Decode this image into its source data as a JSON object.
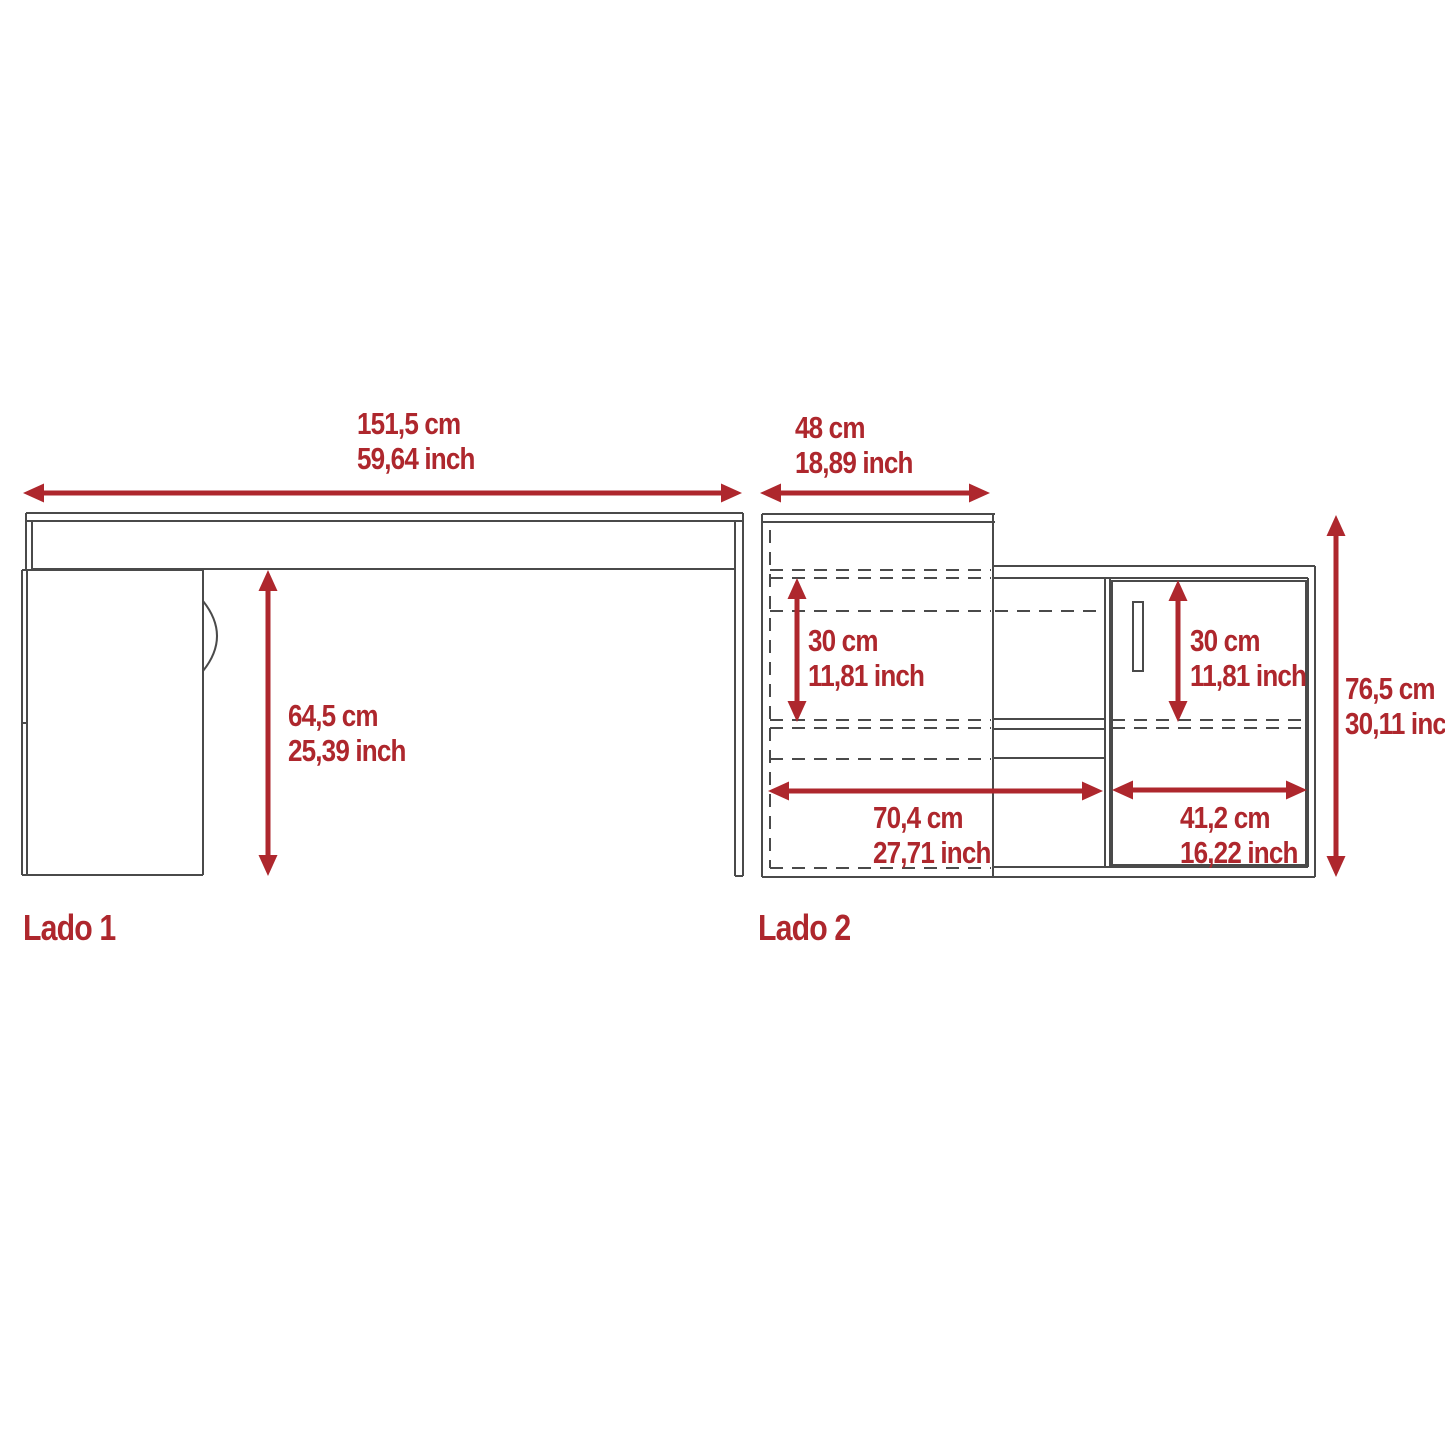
{
  "colors": {
    "accent": "#AE272D",
    "line": "#4A4A4A"
  },
  "lado1": {
    "label": "Lado 1",
    "width_cm": "151,5 cm",
    "width_inch": "59,64 inch",
    "height_cm": "64,5 cm",
    "height_inch": "25,39 inch"
  },
  "lado2": {
    "label": "Lado 2",
    "top_width_cm": "48 cm",
    "top_width_inch": "18,89 inch",
    "left_clearance_cm": "30 cm",
    "left_clearance_inch": "11,81 inch",
    "door_clearance_cm": "30 cm",
    "door_clearance_inch": "11,81 inch",
    "left_width_cm": "70,4 cm",
    "left_width_inch": "27,71 inch",
    "door_width_cm": "41,2 cm",
    "door_width_inch": "16,22 inch",
    "height_cm": "76,5 cm",
    "height_inch": "30,11 inch"
  }
}
